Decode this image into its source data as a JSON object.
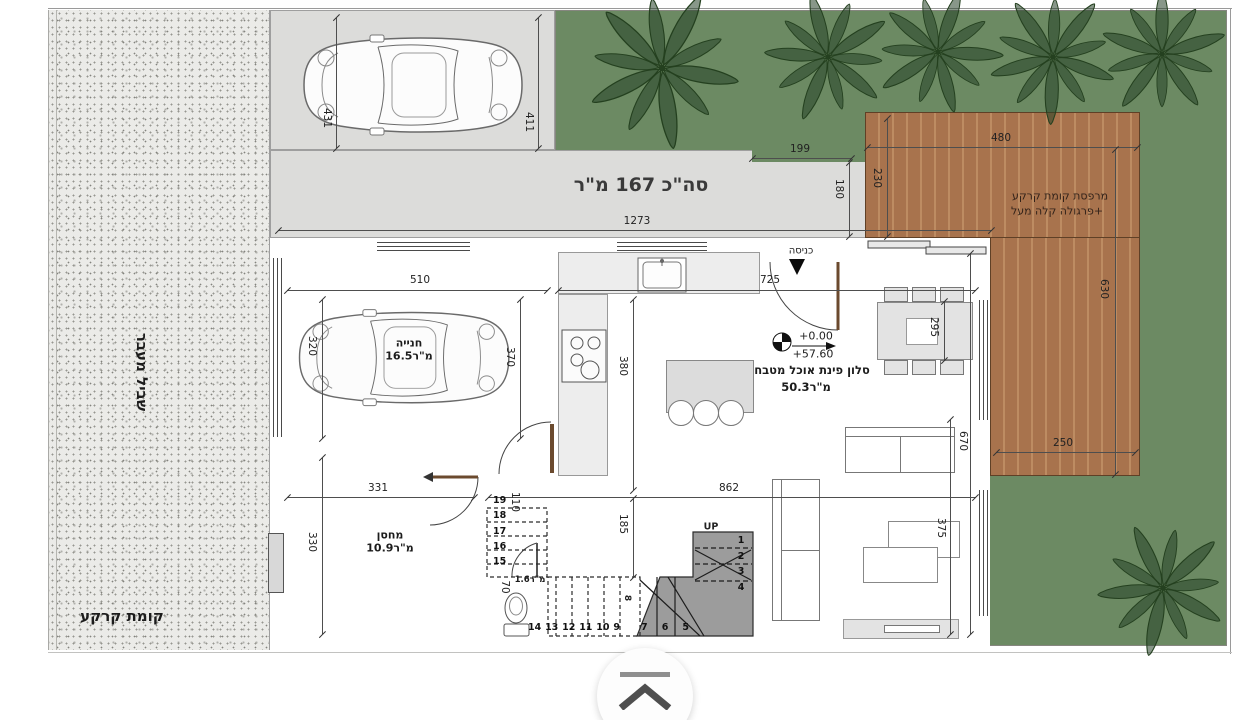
{
  "site": {
    "path_label": "שביל מעבר",
    "floor_label": "קומת קרקע",
    "total_area": "סה\"כ 167 מ\"ר"
  },
  "rooms": {
    "garage": {
      "name": "חנייה",
      "area": "16.5מ\"ר"
    },
    "storage": {
      "name": "מחסן",
      "area": "10.9מ\"ר"
    },
    "living": {
      "name": "סלון פינת אוכל מטבח",
      "area": "50.3מ\"ר"
    },
    "wc": {
      "area": "1.6מ\"ר"
    },
    "terrace": {
      "line1": "מרפסת קומת קרקע",
      "line2": "+פרגולה קלה מעל"
    }
  },
  "entry": {
    "label": "כניסה",
    "level_zero": "+0.00",
    "level_abs": "+57.60"
  },
  "stairs": {
    "up_label": "UP",
    "flight_right": [
      "1",
      "2",
      "3",
      "4"
    ],
    "flight_bottom_solid": [
      "7",
      "6",
      "5"
    ],
    "flight_bottom_hidden": [
      "14",
      "13",
      "12",
      "11",
      "10",
      "9"
    ],
    "flight_upper_hidden": [
      "19",
      "18",
      "17",
      "16",
      "15"
    ],
    "step8": "8"
  },
  "dims": {
    "parking_left": "431",
    "parking_right": "411",
    "overall": "1273",
    "step_w": "199",
    "strip_h": "180",
    "deck_left": "230",
    "deck_top": "480",
    "deck_right": "630",
    "deck_bottom": "250",
    "garage_w": "510",
    "entry_span": "725",
    "garage_h_left": "320",
    "garage_h_right": "370",
    "kitchen_h": "380",
    "table": "295",
    "hall_w": "862",
    "storage_w": "331",
    "storage_h": "330",
    "stair_hall": "185",
    "landing": "110",
    "wc_w": "70",
    "living_h": "670",
    "living_w": "375"
  },
  "ui": {
    "scroll_button_icon": "collapse-up-icon"
  },
  "colors": {
    "garden": "#6c8a63",
    "deck": "#a8734d",
    "concrete": "#dcdcda",
    "pathway": "#ebebe8",
    "wall": "#0b0b0b",
    "stairs": "#9c9c9c",
    "door": "#6b4a2e"
  }
}
